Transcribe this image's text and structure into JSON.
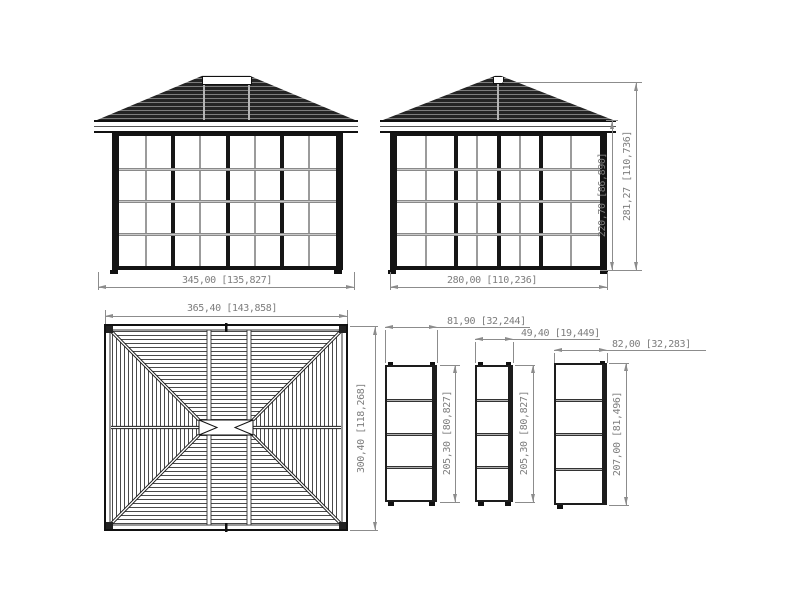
{
  "drawing": {
    "front_view": {
      "name": "front elevation",
      "width_dim": "345,00 [135,827]"
    },
    "side_view": {
      "name": "side elevation",
      "width_dim": "280,00 [110,236]",
      "wall_height_dim": "220,70 [86,890]",
      "total_height_dim": "281,27 [110,736]"
    },
    "roof_plan": {
      "name": "roof plan (top view)",
      "width_dim": "365,40 [143,858]",
      "depth_dim": "300,40 [118,268]"
    },
    "panels": [
      {
        "name": "wide sliding panel",
        "width_dim": "81,90 [32,244]",
        "height_dim": "205,30 [80,827]"
      },
      {
        "name": "narrow sliding panel",
        "width_dim": "49,40 [19,449]",
        "height_dim": "205,30 [80,827]"
      },
      {
        "name": "fixed panel",
        "width_dim": "82,00 [32,283]",
        "height_dim": "207,00 [81,496]"
      }
    ],
    "colors": {
      "line": "#1a1a1a",
      "roof_fill": "#242424",
      "dimension": "#8c8c8c",
      "dimension_text": "#7d7d7d",
      "mullion": "#9b9b9b",
      "glass": "#ffffff"
    }
  }
}
